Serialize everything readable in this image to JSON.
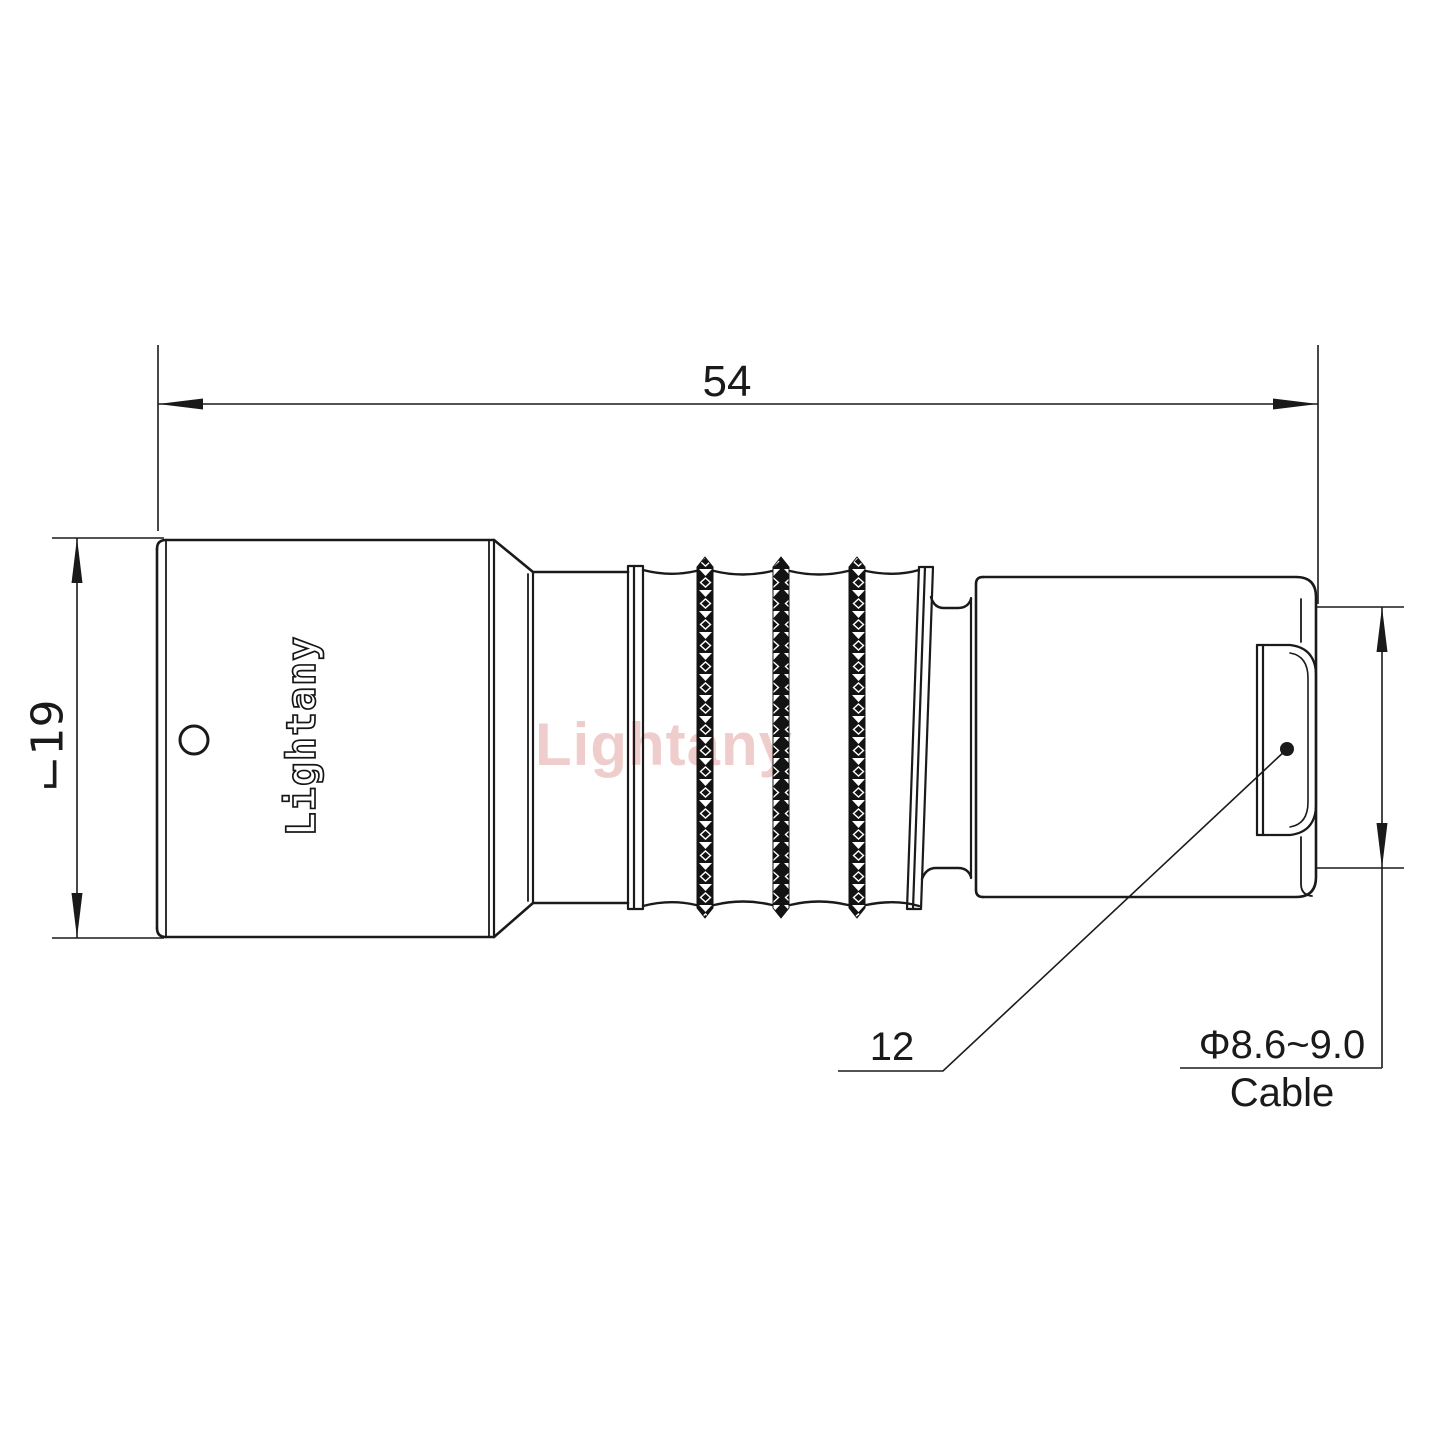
{
  "page": {
    "background": "#ffffff"
  },
  "drawing": {
    "logo_text": "Lightany",
    "watermark_text": "Lightany",
    "colors": {
      "line": "#1a1a1a",
      "watermark_pink": "#eec5c5"
    },
    "dimensions": {
      "overall_length": "54",
      "body_diameter": "⌙19",
      "nut_across_flats": "12",
      "cable_diameter": "Φ8.6~9.0",
      "cable_label": "Cable"
    }
  }
}
